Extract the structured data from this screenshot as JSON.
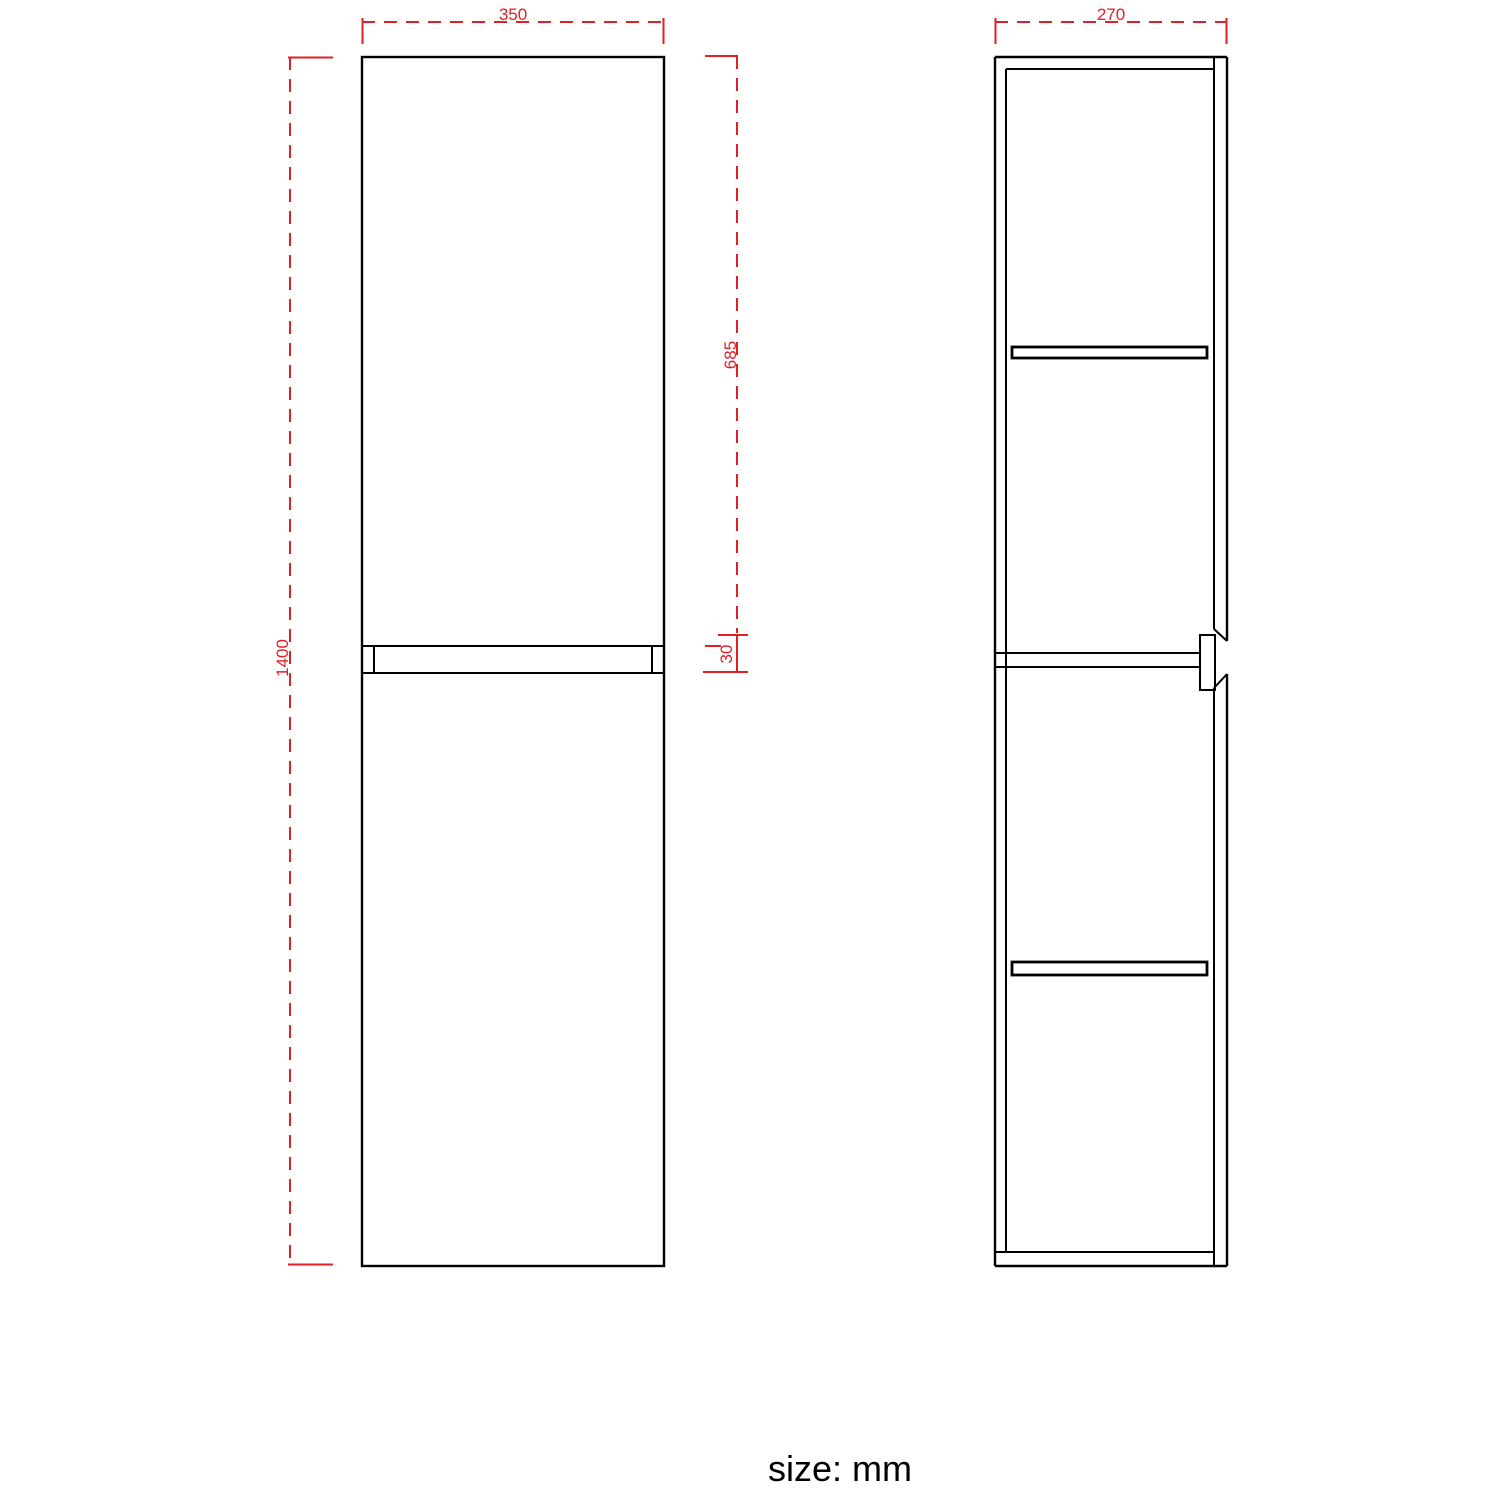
{
  "note": "size: mm",
  "front_view": {
    "width": "350",
    "height": "1400",
    "upper_section": "685",
    "gap": "30"
  },
  "side_view": {
    "depth": "270"
  },
  "colors": {
    "dimension": "#e11f26",
    "outline": "#000000",
    "background": "#ffffff"
  }
}
